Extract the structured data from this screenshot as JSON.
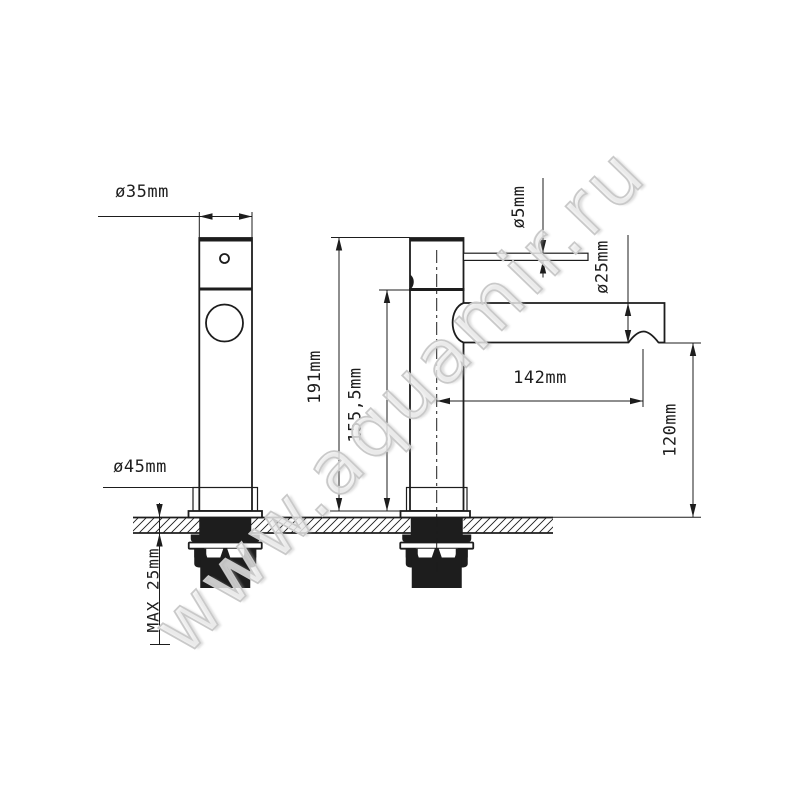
{
  "colors": {
    "line": "#1d1d1d",
    "watermark_stroke": "#c9c9c9",
    "background": "#ffffff"
  },
  "watermark": "www.aquamir.ru",
  "dimensions": {
    "body_diameter": "ø35mm",
    "base_diameter": "ø45mm",
    "total_height": "191mm",
    "spout_height": "155,5mm",
    "handle_pin_diameter": "ø5mm",
    "spout_diameter": "ø25mm",
    "spout_reach": "142mm",
    "outlet_height": "120mm",
    "max_countertop_thickness": "MAX 25mm"
  }
}
